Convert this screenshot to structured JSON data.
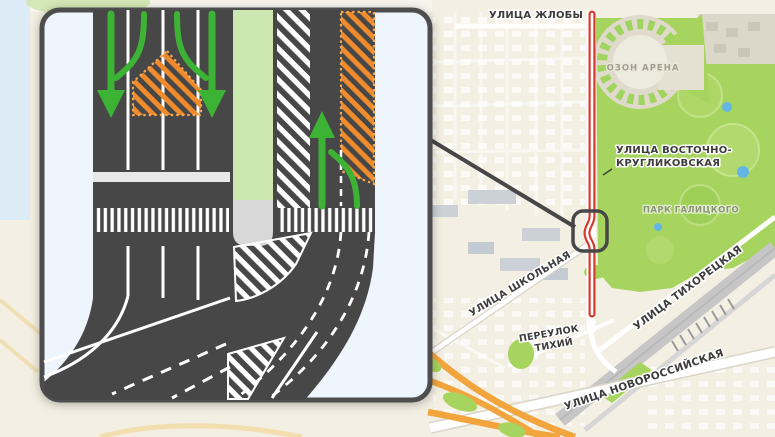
{
  "map": {
    "labels": {
      "ulitsa_zhloby": "УЛИЦА ЖЛОБЫ",
      "ozon_arena": "ОЗОН АРЕНА",
      "ulitsa_vostochno_line1": "УЛИЦА ВОСТОЧНО-",
      "ulitsa_vostochno_line2": "КРУГЛИКОВСКАЯ",
      "park_galitskogo": "ПАРК ГАЛИЦКОГО",
      "ulitsa_shkolnaya": "УЛИЦА ШКОЛЬНАЯ",
      "pereulok_tikhiy_line1": "ПЕРЕУЛОК",
      "pereulok_tikhiy_line2": "ТИХИЙ",
      "ulitsa_tikhoretskaya": "УЛИЦА ТИХОРЕЦКАЯ",
      "ulitsa_novorossiyskaya": "УЛИЦА НОВОРОССИЙСКАЯ"
    },
    "colors": {
      "map_background": "#f3efe2",
      "park_green": "#a7d45f",
      "route_red": "#d63a30",
      "highway_orange": "#f2a53d",
      "railway_gray": "#c6c6c6",
      "water_blue": "#dcebf5"
    }
  },
  "inset": {
    "colors": {
      "road_dark": "#474747",
      "lane_marking_white": "#ffffff",
      "arrow_green": "#3db335",
      "closed_zone_orange": "#ef8b2d",
      "median_green": "#cde7b0",
      "median_island_gray": "#d8d8d8",
      "sidewalk_light": "#eff5fc",
      "border_gray": "#4d4d4d"
    }
  }
}
